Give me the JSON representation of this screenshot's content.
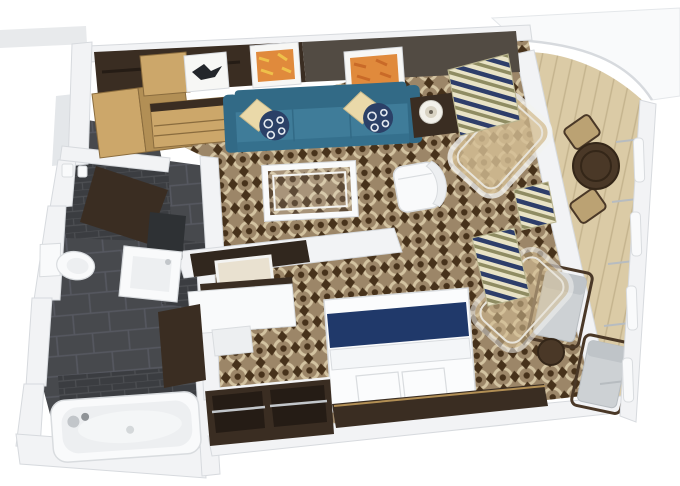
{
  "scene": {
    "type": "3d-floorplan-render",
    "subject": "suite cabin with balcony floor plan"
  },
  "colors": {
    "bg": "#ffffff",
    "wall": "#f2f3f5",
    "wallEdge": "#d7dade",
    "wallShade": "#e4e7ea",
    "grayStrip": "#e8eaec",
    "carpetBase": "#9c8668",
    "carpetDark": "#47321b",
    "carpetLight": "#d3c3a1",
    "tileFloor": "#47494d",
    "tileLine": "#565860",
    "tileWall": "#3b3d41",
    "tileWallLine": "#4d4f53",
    "deck": "#dbcba6",
    "deckLine": "#c4b38d",
    "espresso": "#3a2d22",
    "espressoDark": "#251c15",
    "sofaWall": "#524b43",
    "woodLight": "#cca76a",
    "woodDeep": "#b28f55",
    "teal": "#3f7c99",
    "tealDark": "#326a86",
    "tealFront": "#35708d",
    "cream": "#ead9a9",
    "navy": "#2b4067",
    "bedNavy": "#20396a",
    "whiteF": "#f9fafb",
    "whiteEdge": "#d9dcdf",
    "softGray": "#edeff1",
    "chrome": "#c2c6ca",
    "mirror": "#e9e1d0",
    "tv": "#31271e",
    "artFrame": "#f7f7f5",
    "artDark": "#23262b",
    "artOrange": "#e08a3c",
    "artOrangeDeep": "#c96a28",
    "artYellow": "#efc04a",
    "glassTan": "#d6c096",
    "glassFrame": "#f3f3f1",
    "stripeNavy": "#2e3e6a",
    "stripeCream": "#e9e3c6",
    "stripeOlive": "#8f8c62",
    "cushion": "#cdd1d4",
    "cushionEdge": "#b7bcc0",
    "balconyWood": "#4a3827",
    "balconyWoodRing": "#342618",
    "chairTan": "#bba273",
    "lampShade": "#f3f1ea",
    "lampInner": "#d9d3c3",
    "bedWhite": "#fbfcfd",
    "foldWhite": "#f4f6f8"
  }
}
